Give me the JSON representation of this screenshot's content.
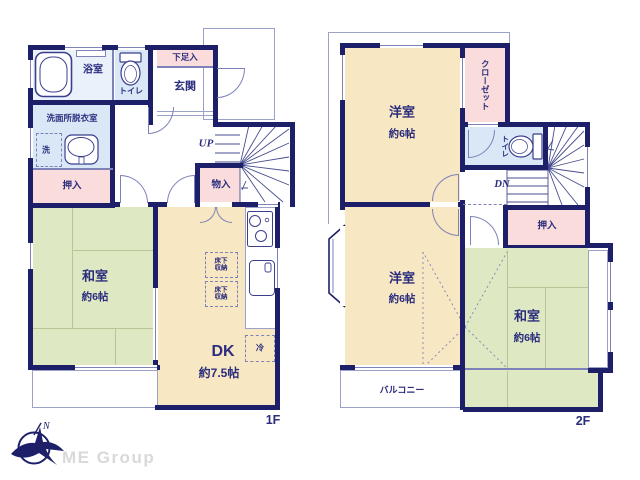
{
  "brand": {
    "name": "ME Group",
    "compass_north": "N"
  },
  "colors": {
    "wall": "#1d2069",
    "text": "#2b2d7e",
    "room_tan": "#f7e7c2",
    "room_green": "#dee8c2",
    "room_pink": "#fadcdc",
    "room_blue": "#d9e7f6",
    "watermark": "#d9d9d9"
  },
  "floor1": {
    "floor_label": "1F",
    "bathroom": "浴室",
    "toilet": "トイレ",
    "shoe_storage": "下足入",
    "entrance": "玄関",
    "washroom": "洗面所脱衣室",
    "washer": "洗",
    "closet": "押入",
    "storage": "物入",
    "stairs_up": "UP",
    "washitsu_name": "和室",
    "washitsu_size": "約6帖",
    "dk_name": "DK",
    "dk_size": "約7.5帖",
    "underfloor_line1": "床下",
    "underfloor_line2": "収納",
    "fridge": "冷"
  },
  "floor2": {
    "floor_label": "2F",
    "bedroom1_name": "洋室",
    "bedroom1_size": "約6帖",
    "closet": "クローゼット",
    "toilet": "トイレ",
    "stairs_down": "DN",
    "oshiire": "押入",
    "bedroom2_name": "洋室",
    "bedroom2_size": "約6帖",
    "washitsu_name": "和室",
    "washitsu_size": "約6帖",
    "balcony": "バルコニー"
  }
}
